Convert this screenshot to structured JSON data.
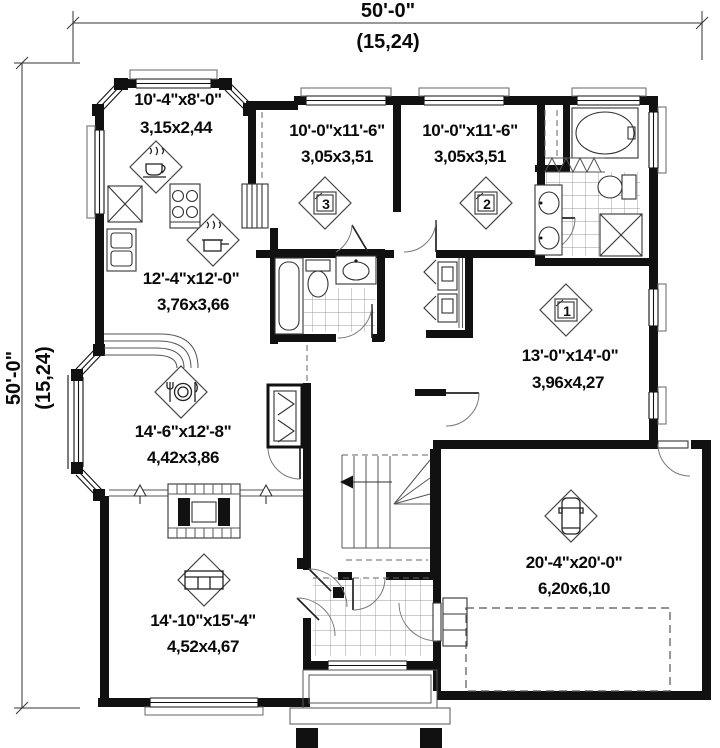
{
  "plan": {
    "dimensions": {
      "top": {
        "imperial": "50'-0\"",
        "metric": "(15,24)"
      },
      "left": {
        "imperial": "50'-0\"",
        "metric": "(15,24)"
      }
    },
    "rooms": {
      "breakfast_nook": {
        "imperial": "10'-4\"x8'-0\"",
        "metric": "3,15x2,44"
      },
      "bedroom3": {
        "imperial": "10'-0\"x11'-6\"",
        "metric": "3,05x3,51",
        "number": "3"
      },
      "bedroom2": {
        "imperial": "10'-0\"x11'-6\"",
        "metric": "3,05x3,51",
        "number": "2"
      },
      "kitchen": {
        "imperial": "12'-4\"x12'-0\"",
        "metric": "3,76x3,66"
      },
      "master_bedroom": {
        "imperial": "13'-0\"x14'-0\"",
        "metric": "3,96x4,27",
        "number": "1"
      },
      "dining_room": {
        "imperial": "14'-6\"x12'-8\"",
        "metric": "4,42x3,86"
      },
      "living_room": {
        "imperial": "14'-10\"x15'-4\"",
        "metric": "4,52x4,67"
      },
      "garage": {
        "imperial": "20'-4\"x20'-0\"",
        "metric": "6,20x6,10"
      }
    },
    "icons": {
      "breakfast_nook": "coffee-cup-icon",
      "kitchen": "cooking-pot-icon",
      "bedrooms": "bed-number-icon",
      "dining_room": "place-setting-icon",
      "living_room": "sofa-icon",
      "garage": "car-icon"
    },
    "colors": {
      "wall": "#111111",
      "line": "#555555",
      "background": "#ffffff"
    }
  }
}
